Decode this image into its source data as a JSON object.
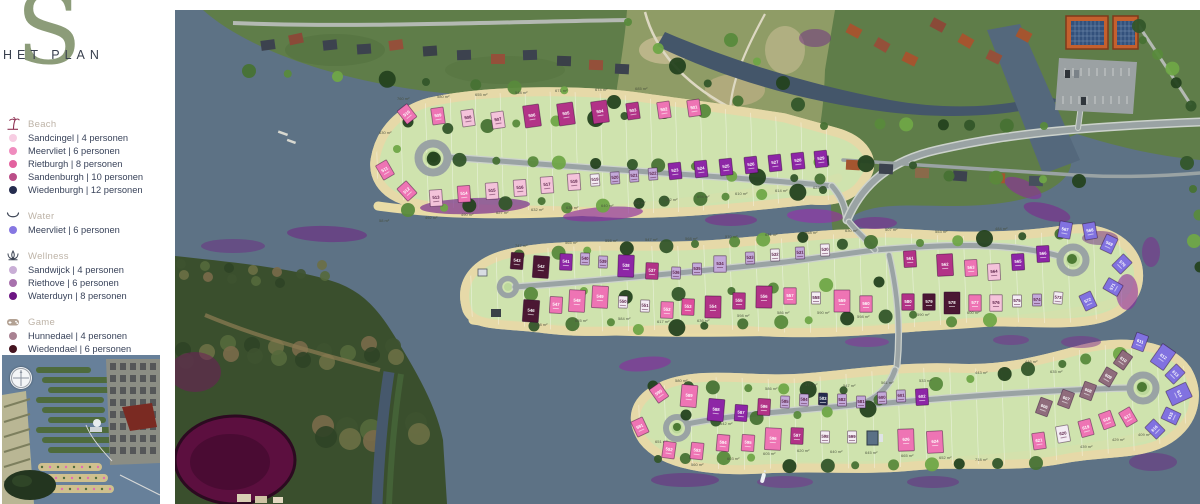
{
  "brand": {
    "logo_s": "S",
    "logo_text": "HET PLAN"
  },
  "legend": {
    "sections": [
      {
        "id": "beach",
        "label": "Beach",
        "icon": "beach-icon",
        "icon_color": "#8d3052",
        "items": [
          {
            "label": "Sandcingel | 4 personen",
            "color": "#f7cde2"
          },
          {
            "label": "Meervliet | 6 personen",
            "color": "#ef8cbe"
          },
          {
            "label": "Rietburgh | 8 personen",
            "color": "#e3629f"
          },
          {
            "label": "Sandenburgh | 10 personen",
            "color": "#bb4e88"
          },
          {
            "label": "Wiedenburgh | 12 personen",
            "color": "#252c4e"
          }
        ]
      },
      {
        "id": "water",
        "label": "Water",
        "icon": "water-icon",
        "icon_color": "#3c4454",
        "items": [
          {
            "label": "Meervliet | 6 personen",
            "color": "#8677e2"
          }
        ]
      },
      {
        "id": "wellness",
        "label": "Wellness",
        "icon": "wellness-icon",
        "icon_color": "#3c4454",
        "items": [
          {
            "label": "Sandwijck | 4 personen",
            "color": "#c9aed6"
          },
          {
            "label": "Riethove | 6 personen",
            "color": "#a871ad"
          },
          {
            "label": "Waterduyn | 8 personen",
            "color": "#6d1583"
          }
        ]
      },
      {
        "id": "game",
        "label": "Game",
        "icon": "game-icon",
        "icon_color": "#b3a294",
        "items": [
          {
            "label": "Hunnedael | 4 personen",
            "color": "#a98292"
          },
          {
            "label": "Wiedendael | 6 personen",
            "color": "#451420"
          }
        ]
      }
    ]
  },
  "map": {
    "colors": {
      "lp": "#f4c3da",
      "pk": "#ee74b4",
      "dp": "#de4f9d",
      "mg": "#b23387",
      "nv": "#252c4e",
      "pu": "#8d26a6",
      "dm": "#4b1733",
      "vi": "#8172e0",
      "lv": "#c3a9d9",
      "wh": "#f4edf4",
      "mv": "#8f6c7c"
    },
    "lots": [
      [
        "510",
        232,
        104,
        "pk",
        "m",
        -38
      ],
      [
        "509",
        263,
        106,
        "pk",
        "m",
        -8
      ],
      [
        "508",
        293,
        108,
        "lp",
        "m",
        -8
      ],
      [
        "507",
        323,
        110,
        "lp",
        "m",
        -8
      ],
      [
        "506",
        357,
        106,
        "mg",
        "b",
        -8
      ],
      [
        "505",
        391,
        104,
        "mg",
        "b",
        -8
      ],
      [
        "504",
        425,
        102,
        "mg",
        "b",
        -8
      ],
      [
        "503",
        458,
        101,
        "mg",
        "m",
        -8
      ],
      [
        "502",
        489,
        100,
        "pk",
        "m",
        -8
      ],
      [
        "501",
        519,
        98,
        "pk",
        "m",
        -8
      ],
      [
        "511",
        210,
        160,
        "pk",
        "m",
        -30
      ],
      [
        "512",
        232,
        181,
        "pk",
        "m",
        -42
      ],
      [
        "513",
        261,
        188,
        "lp",
        "m",
        -4
      ],
      [
        "514",
        289,
        184,
        "pk",
        "m",
        -4
      ],
      [
        "515",
        317,
        181,
        "lp",
        "m",
        -4
      ],
      [
        "516",
        345,
        178,
        "lp",
        "m",
        -4
      ],
      [
        "517",
        372,
        175,
        "lp",
        "m",
        -4
      ],
      [
        "518",
        399,
        172,
        "lp",
        "m",
        -4
      ],
      [
        "519",
        420,
        170,
        "wh",
        "s",
        -4
      ],
      [
        "520",
        440,
        168,
        "lv",
        "s",
        -4
      ],
      [
        "521",
        459,
        166,
        "lv",
        "s",
        -4
      ],
      [
        "522",
        478,
        164,
        "lv",
        "s",
        -4
      ],
      [
        "523",
        500,
        161,
        "pu",
        "m",
        -6
      ],
      [
        "524",
        526,
        159,
        "pu",
        "m",
        -6
      ],
      [
        "525",
        551,
        157,
        "pu",
        "m",
        -6
      ],
      [
        "526",
        576,
        155,
        "pu",
        "m",
        -6
      ],
      [
        "527",
        600,
        153,
        "pu",
        "m",
        -6
      ],
      [
        "528",
        623,
        151,
        "pu",
        "m",
        -6
      ],
      [
        "529",
        646,
        149,
        "pu",
        "m",
        -6
      ],
      [
        "543",
        342,
        251,
        "dm",
        "m",
        4
      ],
      [
        "542",
        366,
        257,
        "dm",
        "b",
        4
      ],
      [
        "541",
        391,
        252,
        "pu",
        "m",
        2
      ],
      [
        "540",
        410,
        249,
        "lv",
        "s",
        2
      ],
      [
        "539",
        428,
        252,
        "lv",
        "s",
        2
      ],
      [
        "538",
        451,
        256,
        "pu",
        "b",
        2
      ],
      [
        "537",
        477,
        261,
        "mg",
        "m",
        2
      ],
      [
        "536",
        501,
        263,
        "lv",
        "s",
        2
      ],
      [
        "535",
        522,
        259,
        "lv",
        "s",
        0
      ],
      [
        "534",
        545,
        254,
        "lv",
        "m",
        0
      ],
      [
        "533",
        575,
        248,
        "lv",
        "s",
        -2
      ],
      [
        "532",
        600,
        245,
        "wh",
        "s",
        -2
      ],
      [
        "531",
        625,
        243,
        "lv",
        "s",
        -2
      ],
      [
        "530",
        650,
        240,
        "wh",
        "s",
        -2
      ],
      [
        "561",
        735,
        249,
        "mg",
        "m",
        -3
      ],
      [
        "562",
        770,
        255,
        "mg",
        "b",
        -3
      ],
      [
        "563",
        796,
        258,
        "pk",
        "m",
        -3
      ],
      [
        "564",
        819,
        262,
        "lp",
        "m",
        -3
      ],
      [
        "565",
        843,
        252,
        "pu",
        "m",
        -3
      ],
      [
        "566",
        868,
        244,
        "pu",
        "m",
        -3
      ],
      [
        "546",
        356,
        301,
        "dm",
        "b",
        4
      ],
      [
        "547",
        381,
        295,
        "pk",
        "m",
        3
      ],
      [
        "548",
        402,
        291,
        "pk",
        "b",
        3
      ],
      [
        "549",
        425,
        287,
        "pk",
        "b",
        3
      ],
      [
        "550",
        448,
        292,
        "wh",
        "s",
        2
      ],
      [
        "551",
        470,
        296,
        "wh",
        "s",
        2
      ],
      [
        "552",
        492,
        300,
        "pk",
        "m",
        2
      ],
      [
        "553",
        513,
        297,
        "dp",
        "m",
        2
      ],
      [
        "554",
        538,
        297,
        "mg",
        "b",
        1
      ],
      [
        "555",
        564,
        291,
        "mg",
        "m",
        1
      ],
      [
        "556",
        589,
        287,
        "mg",
        "b",
        1
      ],
      [
        "557",
        615,
        286,
        "pk",
        "m",
        0
      ],
      [
        "558",
        641,
        288,
        "wh",
        "s",
        0
      ],
      [
        "559",
        667,
        291,
        "pk",
        "b",
        0
      ],
      [
        "560",
        691,
        294,
        "pk",
        "m",
        0
      ],
      [
        "580",
        733,
        292,
        "mg",
        "m",
        0
      ],
      [
        "579",
        754,
        292,
        "dm",
        "m",
        0
      ],
      [
        "578",
        777,
        293,
        "dm",
        "b",
        0
      ],
      [
        "577",
        800,
        293,
        "pk",
        "m",
        0
      ],
      [
        "576",
        821,
        293,
        "lp",
        "m",
        0
      ],
      [
        "575",
        842,
        291,
        "wh",
        "s",
        0
      ],
      [
        "574",
        862,
        290,
        "lv",
        "s",
        0
      ],
      [
        "573",
        883,
        288,
        "wh",
        "s",
        5
      ],
      [
        "567",
        890,
        220,
        "vi",
        "m",
        10
      ],
      [
        "568",
        915,
        221,
        "vi",
        "m",
        -10
      ],
      [
        "569",
        934,
        234,
        "vi",
        "m",
        25
      ],
      [
        "570",
        947,
        254,
        "vi",
        "m",
        45
      ],
      [
        "571",
        938,
        277,
        "vi",
        "m",
        -60
      ],
      [
        "572",
        913,
        291,
        "vi",
        "m",
        -25
      ],
      [
        "590",
        484,
        383,
        "pk",
        "m",
        -35
      ],
      [
        "589",
        514,
        386,
        "pk",
        "b",
        5
      ],
      [
        "588",
        541,
        400,
        "pu",
        "b",
        5
      ],
      [
        "587",
        566,
        403,
        "pu",
        "m",
        4
      ],
      [
        "586",
        589,
        397,
        "mg",
        "m",
        3
      ],
      [
        "585",
        610,
        392,
        "lv",
        "s",
        2
      ],
      [
        "584",
        629,
        390,
        "lv",
        "s",
        2
      ],
      [
        "583",
        648,
        389,
        "nv",
        "s",
        1
      ],
      [
        "582",
        667,
        390,
        "lv",
        "s",
        0
      ],
      [
        "581",
        686,
        392,
        "lv",
        "s",
        0
      ],
      [
        "600",
        707,
        388,
        "lv",
        "s",
        -2
      ],
      [
        "601",
        726,
        386,
        "lv",
        "s",
        -2
      ],
      [
        "602",
        747,
        387,
        "pu",
        "m",
        -3
      ],
      [
        "591",
        465,
        417,
        "pk",
        "m",
        -25
      ],
      [
        "592",
        494,
        440,
        "pk",
        "m",
        8
      ],
      [
        "593",
        522,
        441,
        "pk",
        "m",
        6
      ],
      [
        "594",
        548,
        433,
        "pk",
        "m",
        5
      ],
      [
        "595",
        573,
        433,
        "pk",
        "m",
        4
      ],
      [
        "596",
        598,
        429,
        "pk",
        "b",
        3
      ],
      [
        "597",
        622,
        426,
        "mg",
        "m",
        2
      ],
      [
        "598",
        650,
        427,
        "wh",
        "s",
        1
      ],
      [
        "599",
        677,
        427,
        "wh",
        "s",
        0
      ],
      [
        "626",
        731,
        430,
        "pk",
        "b",
        -2
      ],
      [
        "624",
        760,
        432,
        "pk",
        "b",
        -3
      ],
      [
        "606",
        869,
        397,
        "mv",
        "m",
        20
      ],
      [
        "607",
        891,
        389,
        "mv",
        "m",
        20
      ],
      [
        "608",
        913,
        381,
        "mv",
        "m",
        20
      ],
      [
        "609",
        933,
        367,
        "mv",
        "m",
        30
      ],
      [
        "610",
        948,
        350,
        "mv",
        "m",
        35
      ],
      [
        "611",
        965,
        332,
        "vi",
        "m",
        20
      ],
      [
        "612",
        988,
        347,
        "vi",
        "b",
        35
      ],
      [
        "613",
        1000,
        364,
        "vi",
        "m",
        45
      ],
      [
        "614",
        1004,
        384,
        "vi",
        "b",
        65
      ],
      [
        "615",
        996,
        406,
        "vi",
        "m",
        -65
      ],
      [
        "616",
        980,
        419,
        "vi",
        "m",
        -45
      ],
      [
        "617",
        953,
        407,
        "pk",
        "m",
        -30
      ],
      [
        "618",
        932,
        410,
        "pk",
        "m",
        -20
      ],
      [
        "619",
        911,
        418,
        "pk",
        "m",
        -15
      ],
      [
        "620",
        888,
        424,
        "wh",
        "m",
        -10
      ],
      [
        "621",
        864,
        431,
        "pk",
        "m",
        -8
      ]
    ],
    "area_labels": [
      [
        "760 m²",
        222,
        90
      ],
      [
        "580 m²",
        262,
        88
      ],
      [
        "655 m²",
        300,
        86
      ],
      [
        "548 m²",
        340,
        84
      ],
      [
        "671 m²",
        380,
        82
      ],
      [
        "674 m²",
        420,
        81
      ],
      [
        "685 m²",
        460,
        80
      ],
      [
        "630 m²",
        204,
        124
      ],
      [
        "58 m²",
        204,
        212
      ],
      [
        "492 m²",
        250,
        209
      ],
      [
        "490 m²",
        286,
        206
      ],
      [
        "627 m²",
        321,
        204
      ],
      [
        "632 m²",
        356,
        201
      ],
      [
        "636 m²",
        391,
        199
      ],
      [
        "640 m²",
        426,
        197
      ],
      [
        "462 m²",
        458,
        194
      ],
      [
        "482 m²",
        490,
        191
      ],
      [
        "694 m²",
        522,
        188
      ],
      [
        "610 m²",
        560,
        185
      ],
      [
        "614 m²",
        600,
        182
      ],
      [
        "623 m²",
        638,
        179
      ],
      [
        "747 m²",
        340,
        237
      ],
      [
        "565 m²",
        390,
        234
      ],
      [
        "558 m²",
        430,
        232
      ],
      [
        "547 m²",
        470,
        231
      ],
      [
        "568 m²",
        510,
        230
      ],
      [
        "570 m²",
        550,
        228
      ],
      [
        "631 m²",
        590,
        226
      ],
      [
        "558 m²",
        630,
        224
      ],
      [
        "630 m²",
        670,
        222
      ],
      [
        "507 m²",
        710,
        221
      ],
      [
        "553 m²",
        760,
        223
      ],
      [
        "484 m²",
        820,
        220
      ],
      [
        "608 m²",
        360,
        316
      ],
      [
        "655 m²",
        400,
        312
      ],
      [
        "584 m²",
        443,
        310
      ],
      [
        "617 m²",
        482,
        313
      ],
      [
        "636 m²",
        522,
        312
      ],
      [
        "598 m²",
        562,
        307
      ],
      [
        "586 m²",
        602,
        304
      ],
      [
        "590 m²",
        642,
        304
      ],
      [
        "598 m²",
        682,
        308
      ],
      [
        "590 m²",
        742,
        306
      ],
      [
        "600 m²",
        792,
        304
      ],
      [
        "580 m²",
        500,
        372
      ],
      [
        "542 m²",
        545,
        415
      ],
      [
        "586 m²",
        590,
        380
      ],
      [
        "477 m²",
        630,
        376
      ],
      [
        "547 m²",
        668,
        377
      ],
      [
        "561 m²",
        706,
        374
      ],
      [
        "533 m²",
        744,
        372
      ],
      [
        "443 m²",
        800,
        364
      ],
      [
        "446 m²",
        850,
        353
      ],
      [
        "635 m²",
        875,
        363
      ],
      [
        "651 m²",
        480,
        433
      ],
      [
        "560 m²",
        516,
        456
      ],
      [
        "603 m²",
        552,
        450
      ],
      [
        "605 m²",
        588,
        445
      ],
      [
        "620 m²",
        622,
        442
      ],
      [
        "640 m²",
        655,
        443
      ],
      [
        "645 m²",
        690,
        444
      ],
      [
        "665 m²",
        726,
        447
      ],
      [
        "652 m²",
        764,
        449
      ],
      [
        "718 m²",
        800,
        451
      ],
      [
        "439 m²",
        905,
        438
      ],
      [
        "429 m²",
        937,
        431
      ],
      [
        "409 m²",
        963,
        426
      ]
    ]
  }
}
